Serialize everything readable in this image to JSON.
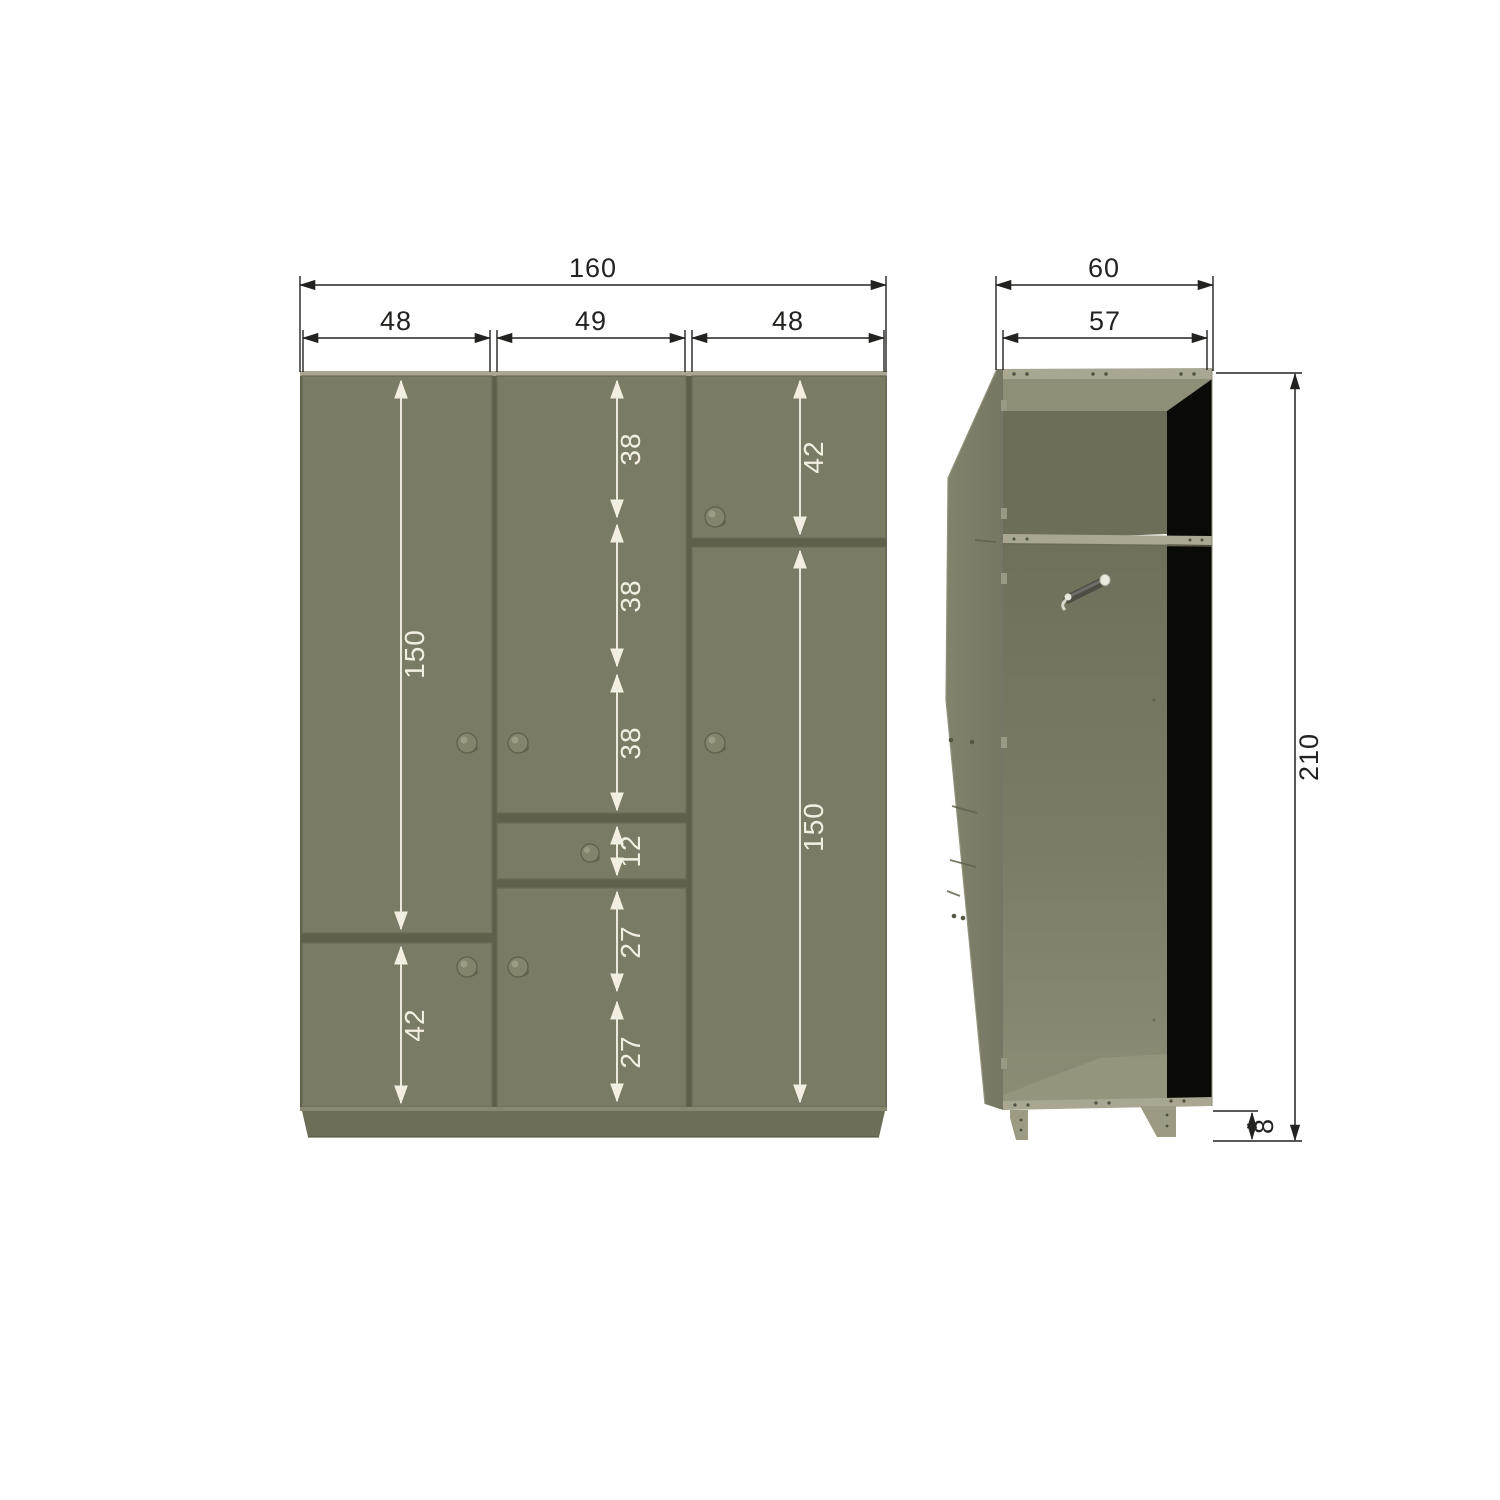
{
  "front": {
    "overall_width": "160",
    "column_widths": [
      "48",
      "49",
      "48"
    ],
    "columns": {
      "left": {
        "door_height": "150",
        "lower_door_height": "42"
      },
      "middle": {
        "upper_segments": [
          "38",
          "38",
          "38"
        ],
        "drawer_height": "12",
        "lower_segments": [
          "27",
          "27"
        ]
      },
      "right": {
        "upper_door_height": "42",
        "door_height": "150"
      }
    }
  },
  "side": {
    "overall_depth": "60",
    "interior_depth": "57",
    "overall_height": "210",
    "base_height": "8"
  },
  "colors": {
    "door_face": "#7a7b64",
    "panel_gap": "#5f604b",
    "panel_edge_light": "#a9a692",
    "interior_back_shadow": "#0a0a06",
    "plinth": "#6d6e57",
    "dimension_black": "#222220",
    "dimension_white": "#f2efe2",
    "background": "#ffffff"
  }
}
